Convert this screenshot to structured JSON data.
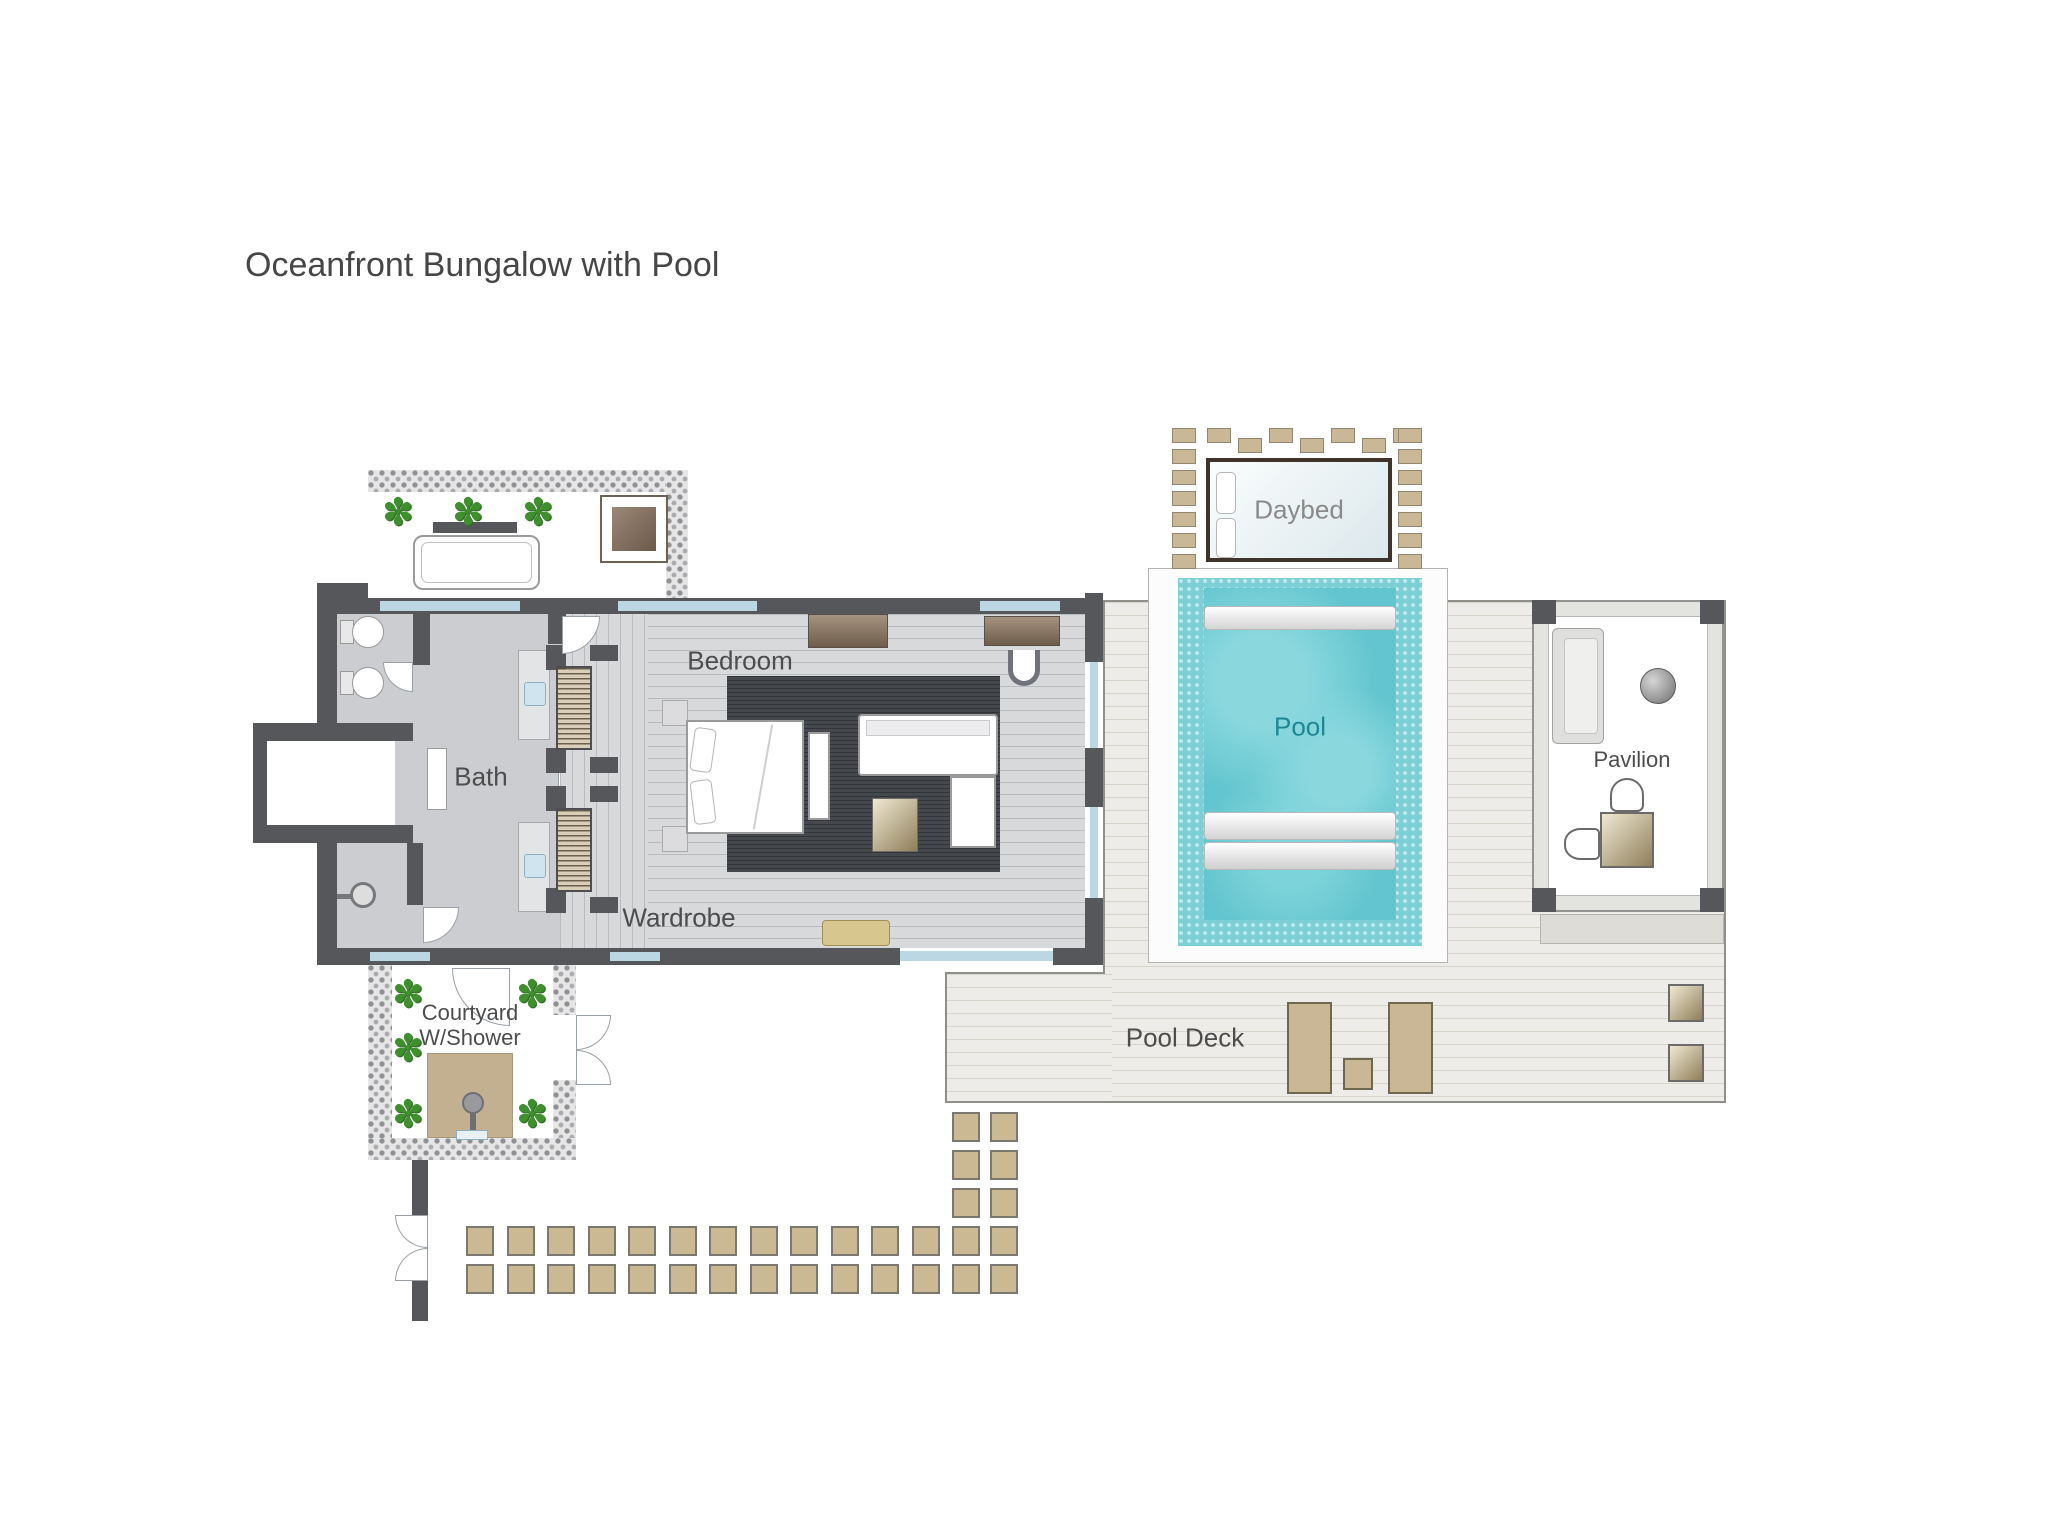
{
  "title": "Oceanfront Bungalow with Pool",
  "labels": {
    "bath": "Bath",
    "bedroom": "Bedroom",
    "wardrobe": "Wardrobe",
    "courtyard_line1": "Courtyard",
    "courtyard_line2": "W/Shower",
    "daybed": "Daybed",
    "pool": "Pool",
    "pavilion": "Pavilion",
    "pool_deck": "Pool Deck"
  },
  "icons": {
    "plant": "✽"
  },
  "colors": {
    "wall": "#55575b",
    "bath_floor": "#cbcdd0",
    "wood_floor": "#d8d9db",
    "rug": "#45494d",
    "deck": "#edece8",
    "water": "#63c5cf",
    "tile": "#7dcfd6",
    "window_glass": "#bcd7e4",
    "pebble_bg": "#e6e6e6",
    "pebble_dot": "#8f9094",
    "stone_tan": "#cbb994",
    "paver_tan": "#c9b795",
    "platform_tan": "#c2b091",
    "console_brown": "#8a7a6b",
    "plant_green": "#3f8f2f",
    "label_text": "#4d4d4d",
    "pool_label": "#1f8793",
    "daybed_border": "#3f342b",
    "lounger_border": "#6d684e"
  },
  "decor": {
    "path_cols": 12,
    "path_rows": 2,
    "path_vertical_rows": 5,
    "daybed_pavers_top": 7,
    "daybed_pavers_side": 7,
    "plant_positions": [
      [
        382,
        494
      ],
      [
        452,
        494
      ],
      [
        522,
        494
      ],
      [
        392,
        976
      ],
      [
        516,
        976
      ],
      [
        392,
        1030
      ],
      [
        392,
        1096
      ],
      [
        516,
        1096
      ]
    ]
  }
}
